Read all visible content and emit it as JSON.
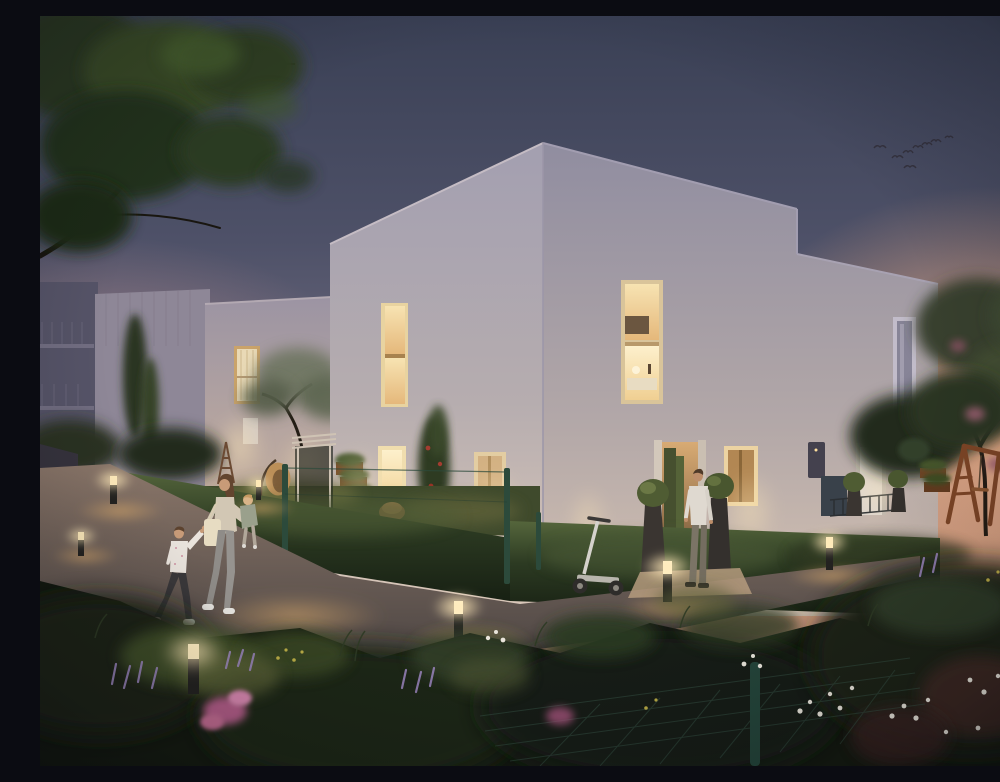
{
  "scene": {
    "alt": "Dusk architectural rendering: white modern houses with warm lit windows, a garden path with glowing bollard lights, a woman carrying a toddler and holding a boy's hand, a man standing at a lit doorway, a kick scooter against the wall, hedges, a swing set and flowering plants",
    "time_of_day": "dusk"
  },
  "palette": {
    "sky_top": "#3a4055",
    "sky_mid": "#676579",
    "sunset_glow": "#e8a87f",
    "wall_light": "#d9c9bc",
    "wall_shade": "#908da0",
    "window_light": "#f2d9a4",
    "bollard_light": "#ffe7ae",
    "hedge_dark": "#20281e",
    "lawn": "#4a5634",
    "path": "#6b5f5c",
    "flower_pink": "#c06a90",
    "flower_purple": "#9c86c0",
    "flower_white": "#e8e4da",
    "flower_yellow": "#c9b84a",
    "swing_wood": "#7d4526",
    "fence_green": "#2c4a3b"
  },
  "objects": {
    "people_count": 4,
    "people": [
      "woman-carrying-toddler",
      "boy-holding-hand",
      "man-at-door"
    ],
    "bollard_light_count": 7,
    "bird_count": 8,
    "lit_window_count": 6,
    "building_volume_count": 4,
    "items": [
      "kick-scooter",
      "hanging-egg-chair",
      "wooden-swing-set",
      "topiary-planters",
      "pergola",
      "mesh-fence",
      "tote-bag"
    ]
  }
}
